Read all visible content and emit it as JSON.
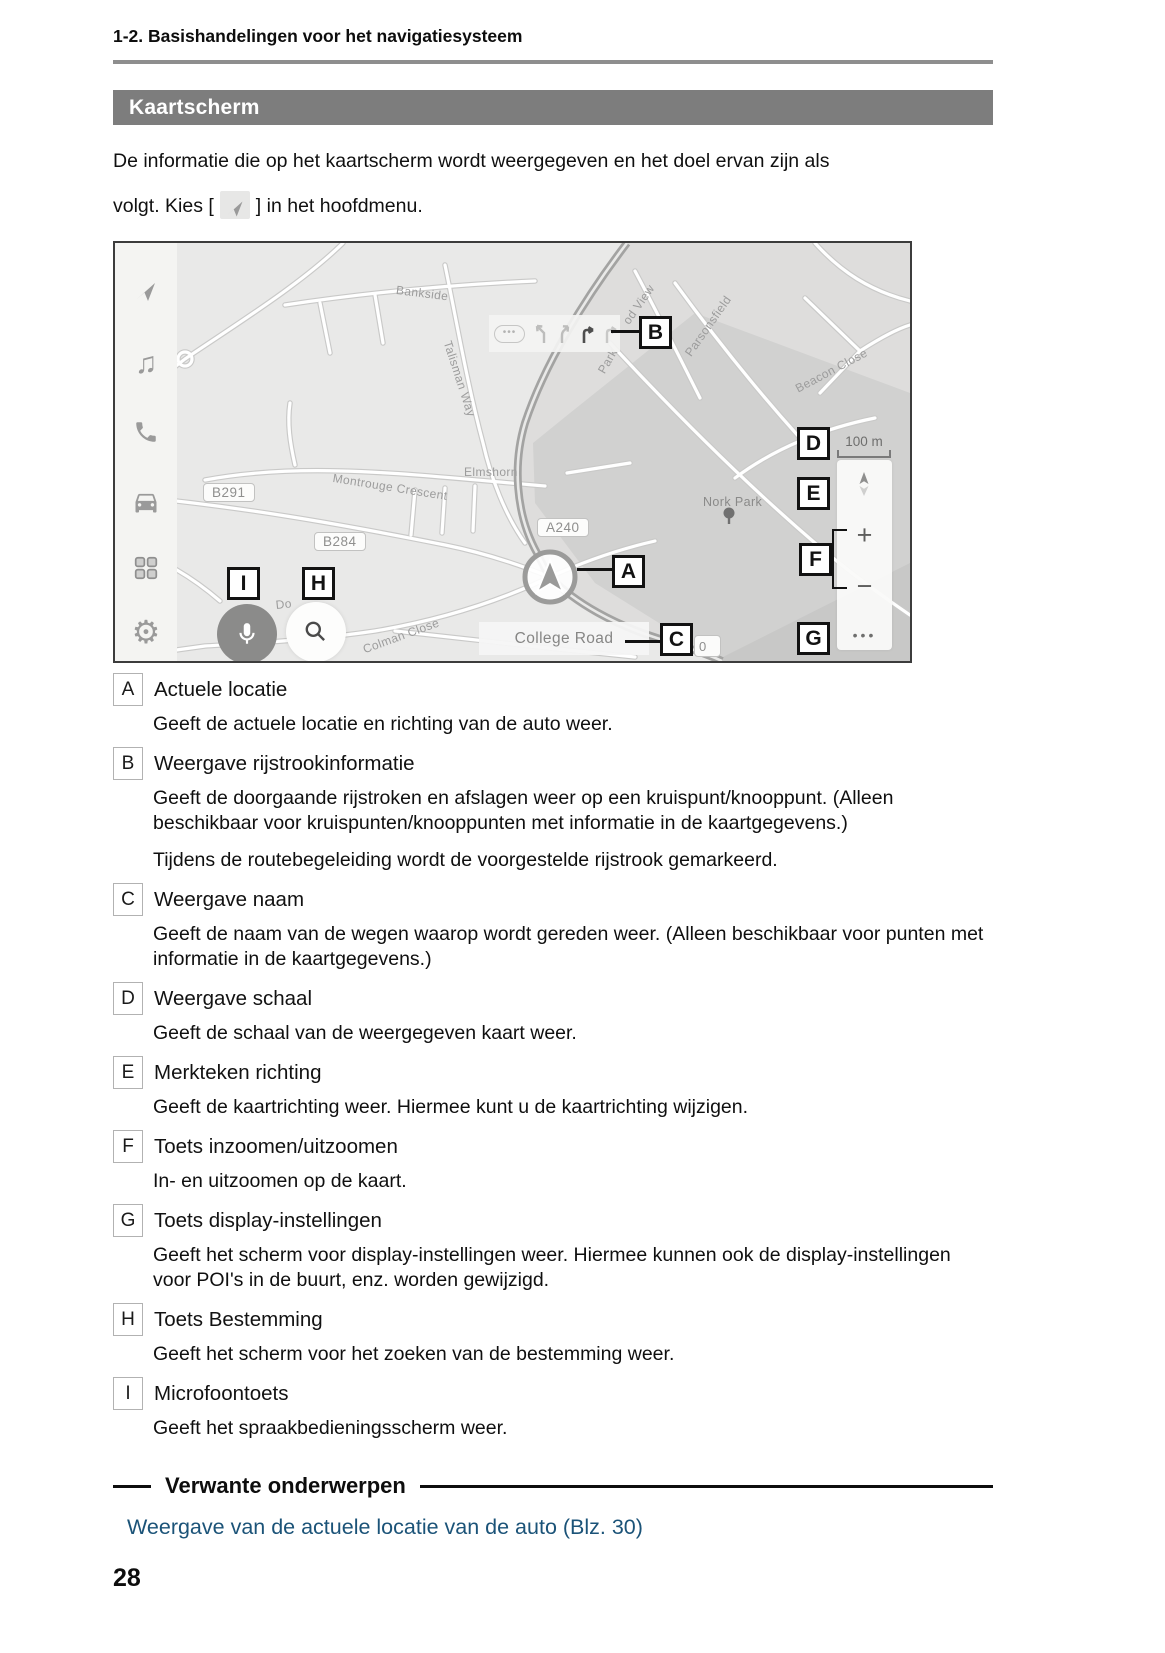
{
  "header": {
    "breadcrumb": "1-2. Basishandelingen voor het navigatiesysteem"
  },
  "banner": {
    "title": "Kaartscherm"
  },
  "intro": {
    "line1": "De informatie die op het kaartscherm wordt weergegeven en het doel ervan zijn als",
    "line2_before": "volgt. Kies [",
    "line2_after": "] in het hoofdmenu."
  },
  "map": {
    "callouts": [
      "A",
      "B",
      "C",
      "D",
      "E",
      "F",
      "G",
      "H",
      "I"
    ],
    "shields": {
      "b291": "B291",
      "b284": "B284",
      "a240": "A240"
    },
    "streets": {
      "bankside": "Bankside",
      "talisman": "Talisman Way",
      "montrouge": "Montrouge Crescent",
      "elmshorn": "Elmshorn",
      "nork_park": "Nork Park",
      "parsonsfield": "Parsonsfield",
      "beacon": "Beacon Close",
      "park_fragment": "Park",
      "view_fragment": "od View",
      "do_fragment": "Do",
      "colman": "Colman Close"
    },
    "lane_bar": {
      "dots": "•••"
    },
    "road_name_bar": "College Road",
    "zero_badge": "0",
    "scale_label": "100 m",
    "controls": {
      "zoom_in": "+",
      "zoom_out": "−",
      "more": "•••"
    },
    "sidebar_icons": [
      "navigation",
      "media",
      "phone",
      "car",
      "apps",
      "settings"
    ]
  },
  "items": [
    {
      "letter": "A",
      "title": "Actuele locatie",
      "descriptions": [
        "Geeft de actuele locatie en richting van de auto weer."
      ]
    },
    {
      "letter": "B",
      "title": "Weergave rijstrookinformatie",
      "descriptions": [
        "Geeft de doorgaande rijstroken en afslagen weer op een kruispunt/knooppunt. (Alleen beschikbaar voor kruispunten/knooppunten met informatie in de kaartgegevens.)",
        "Tijdens de routebegeleiding wordt de voorgestelde rijstrook gemarkeerd."
      ]
    },
    {
      "letter": "C",
      "title": "Weergave naam",
      "descriptions": [
        "Geeft de naam van de wegen waarop wordt gereden weer. (Alleen beschikbaar voor punten met informatie in de kaartgegevens.)"
      ]
    },
    {
      "letter": "D",
      "title": "Weergave schaal",
      "descriptions": [
        "Geeft de schaal van de weergegeven kaart weer."
      ]
    },
    {
      "letter": "E",
      "title": "Merkteken richting",
      "descriptions": [
        "Geeft de kaartrichting weer. Hiermee kunt u de kaartrichting wijzigen."
      ]
    },
    {
      "letter": "F",
      "title": "Toets inzoomen/uitzoomen",
      "descriptions": [
        "In- en uitzoomen op de kaart."
      ]
    },
    {
      "letter": "G",
      "title": "Toets display-instellingen",
      "descriptions": [
        "Geeft het scherm voor display-instellingen weer. Hiermee kunnen ook de display-instellingen voor POI's in de buurt, enz. worden gewijzigd."
      ]
    },
    {
      "letter": "H",
      "title": "Toets Bestemming",
      "descriptions": [
        "Geeft het scherm voor het zoeken van de bestemming weer."
      ]
    },
    {
      "letter": "I",
      "title": "Microfoontoets",
      "descriptions": [
        "Geeft het spraakbedieningsscherm weer."
      ]
    }
  ],
  "related": {
    "heading": "Verwante onderwerpen",
    "link": "Weergave van de actuele locatie van de auto (Blz. 30)"
  },
  "footer": {
    "page_number": "28"
  },
  "colors": {
    "banner": "#7d7d7d",
    "link": "#1b5378",
    "map_bg": "#e9e9e8"
  }
}
